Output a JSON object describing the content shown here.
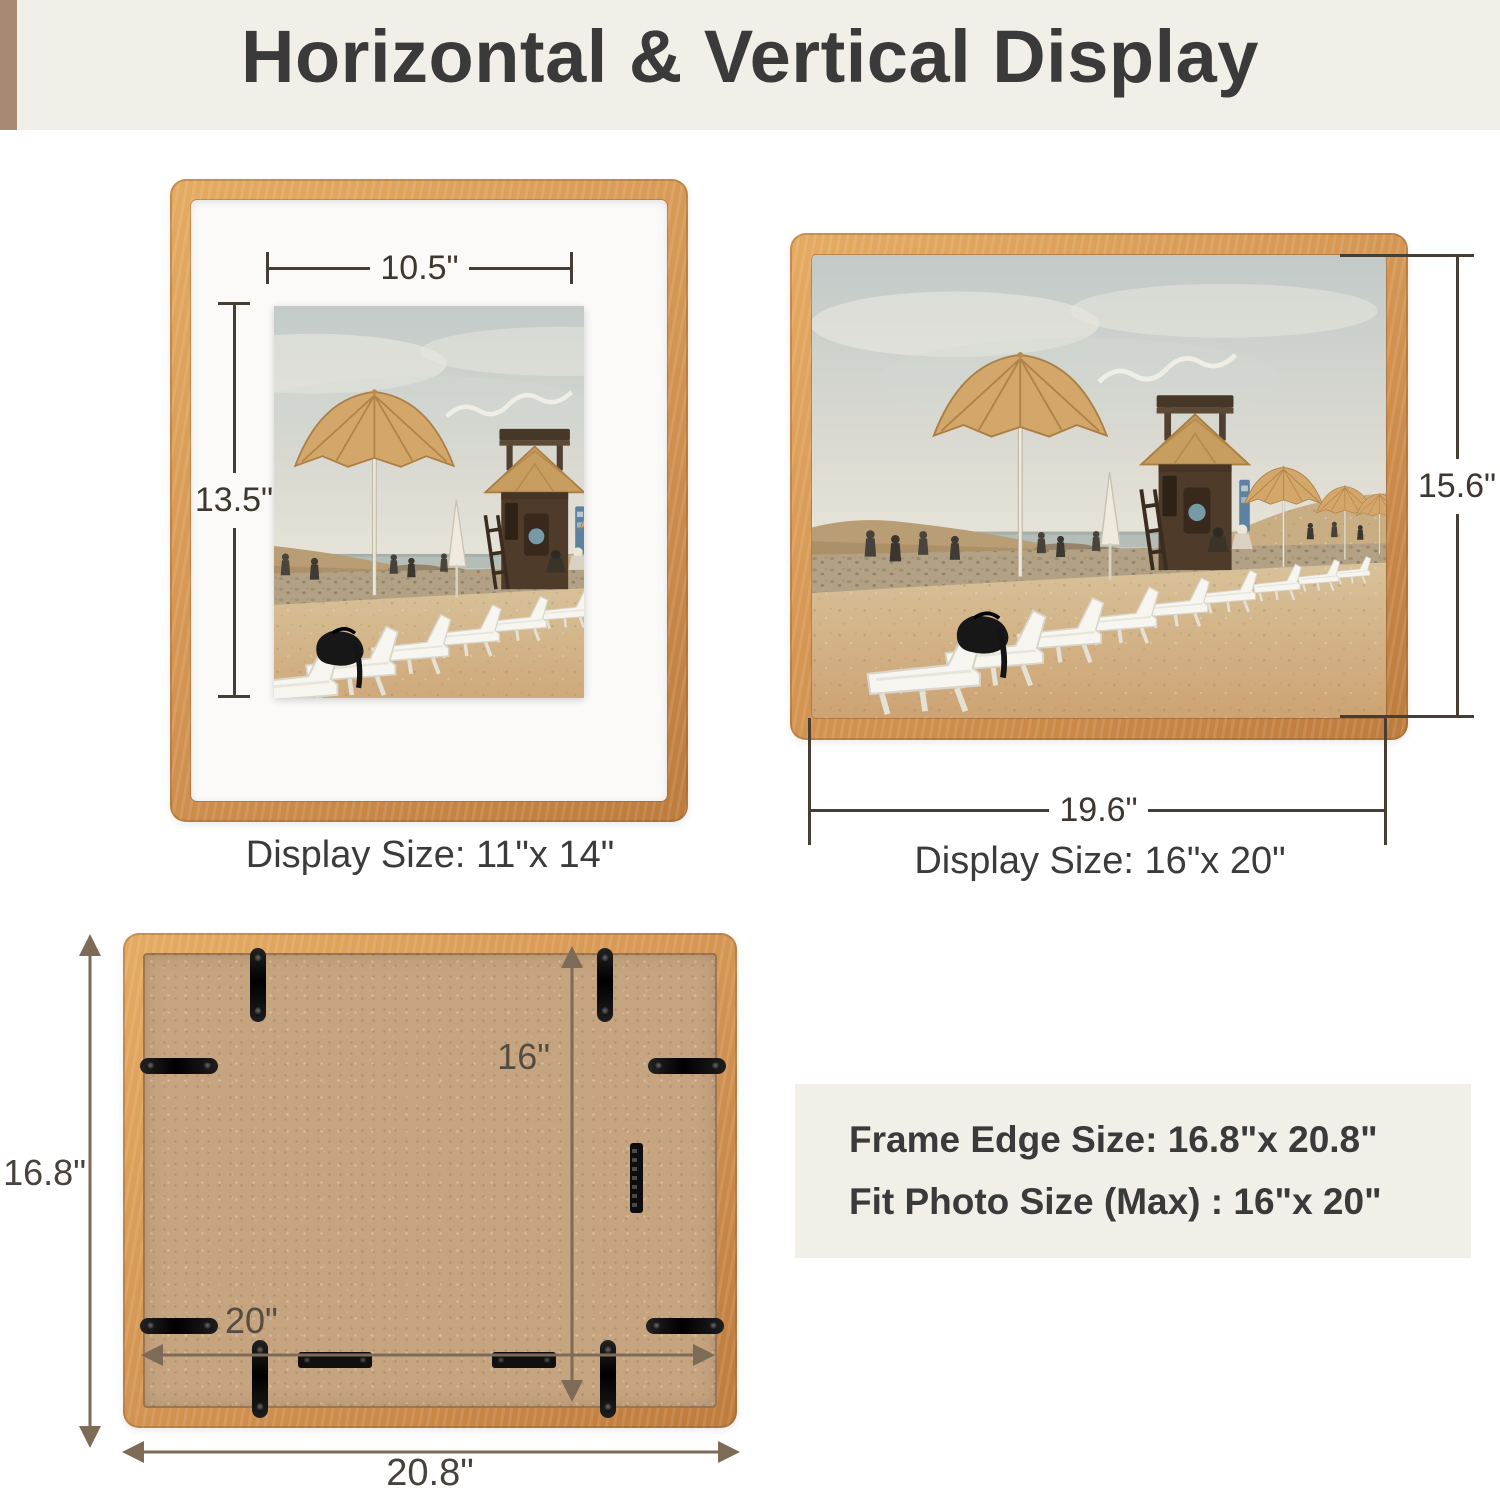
{
  "header": {
    "title": "Horizontal & Vertical Display"
  },
  "vertical_frame": {
    "photo_width_label": "10.5\"",
    "photo_height_label": "13.5\"",
    "caption": "Display Size: 11\"x 14\""
  },
  "horizontal_frame": {
    "photo_width_label": "19.6\"",
    "photo_height_label": "15.6\"",
    "caption": "Display Size: 16\"x 20\""
  },
  "frame_back": {
    "outer_height_label": "16.8\"",
    "outer_width_label": "20.8\"",
    "inner_height_label": "16\"",
    "inner_width_label": "20\""
  },
  "info_box": {
    "line1": "Frame Edge Size: 16.8\"x 20.8\"",
    "line2": "Fit Photo Size (Max) : 16\"x 20\""
  },
  "colors": {
    "cream": "#f2efe8",
    "accent-bar": "#a78a73",
    "wood-light": "#e5ab62",
    "wood-mid": "#d29250",
    "wood-dark": "#bd7b3c",
    "dim-line": "#463d33",
    "arrow-brown": "#7d6a57",
    "text-dark": "#3b3b3b",
    "backing": "#c6a480"
  }
}
